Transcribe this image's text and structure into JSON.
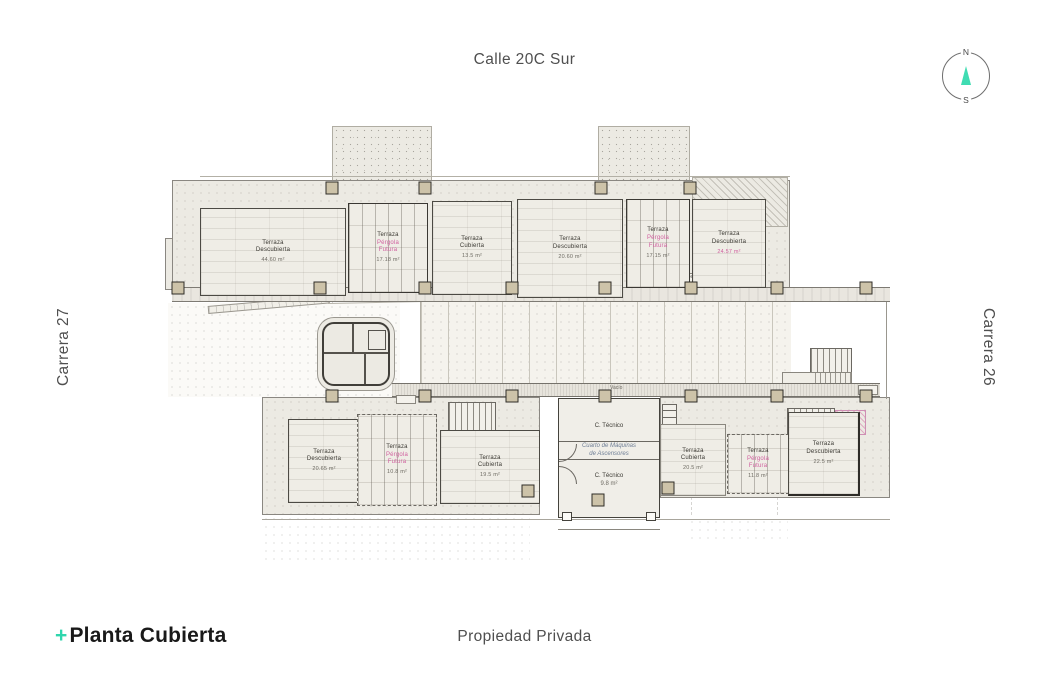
{
  "streets": {
    "top": "Calle 20C Sur",
    "left": "Carrera 27",
    "right": "Carrera 26",
    "bottom": "Propiedad Privada"
  },
  "compass": {
    "north_label": "N",
    "south_label": "S"
  },
  "title": {
    "plus": "+",
    "text": "Planta Cubierta"
  },
  "plan": {
    "rooms": [
      {
        "id": "u1",
        "lines": [
          "Terraza",
          "Descubierta"
        ],
        "area": "44.60 m²",
        "accent": false
      },
      {
        "id": "u2",
        "lines": [
          "Terraza",
          "Pérgola",
          "Futura"
        ],
        "area": "17.18 m²",
        "accent": true
      },
      {
        "id": "u3",
        "lines": [
          "Terraza",
          "Cubierta"
        ],
        "area": "13.5 m²",
        "accent": false
      },
      {
        "id": "u4",
        "lines": [
          "Terraza",
          "Descubierta"
        ],
        "area": "20.60 m²",
        "accent": false
      },
      {
        "id": "u5",
        "lines": [
          "Terraza",
          "Pérgola",
          "Futura"
        ],
        "area": "17.15 m²",
        "accent": true
      },
      {
        "id": "u6",
        "lines": [
          "Terraza",
          "Descubierta"
        ],
        "area": "24.57 m²",
        "accent": false,
        "area_accent": true
      },
      {
        "id": "l1",
        "lines": [
          "Terraza",
          "Descubierta"
        ],
        "area": "20.65 m²",
        "accent": false
      },
      {
        "id": "l2",
        "lines": [
          "Terraza",
          "Pérgola",
          "Futura"
        ],
        "area": "10.8 m²",
        "accent": true
      },
      {
        "id": "l3",
        "lines": [
          "Terraza",
          "Cubierta"
        ],
        "area": "19.5 m²",
        "accent": false
      },
      {
        "id": "l4",
        "lines": [
          "Terraza",
          "Cubierta"
        ],
        "area": "20.5 m²",
        "accent": false
      },
      {
        "id": "l5",
        "lines": [
          "Terraza",
          "Pérgola",
          "Futura"
        ],
        "area": "11.8 m²",
        "accent": true
      },
      {
        "id": "l6",
        "lines": [
          "Terraza",
          "Descubierta"
        ],
        "area": "22.5 m²",
        "accent": false
      }
    ],
    "machine_room": {
      "room_top": "C. Técnico",
      "title_line1": "Cuarto de Máquinas",
      "title_line2": "de Ascensores",
      "room_bottom": "C. Técnico",
      "room_bottom_area": "9.8 m²"
    },
    "annotations": [
      {
        "id": "a1",
        "text": "Sendero peatonal"
      },
      {
        "id": "a2",
        "text": "Sendero peatonal"
      },
      {
        "id": "a3",
        "text": "Vacío"
      }
    ]
  },
  "colors": {
    "accent_teal": "#3fdcb2",
    "accent_pink": "#d0609f",
    "ink": "#191919",
    "street_gray": "#4f4f4f",
    "column_fill": "#cdc3a9"
  }
}
